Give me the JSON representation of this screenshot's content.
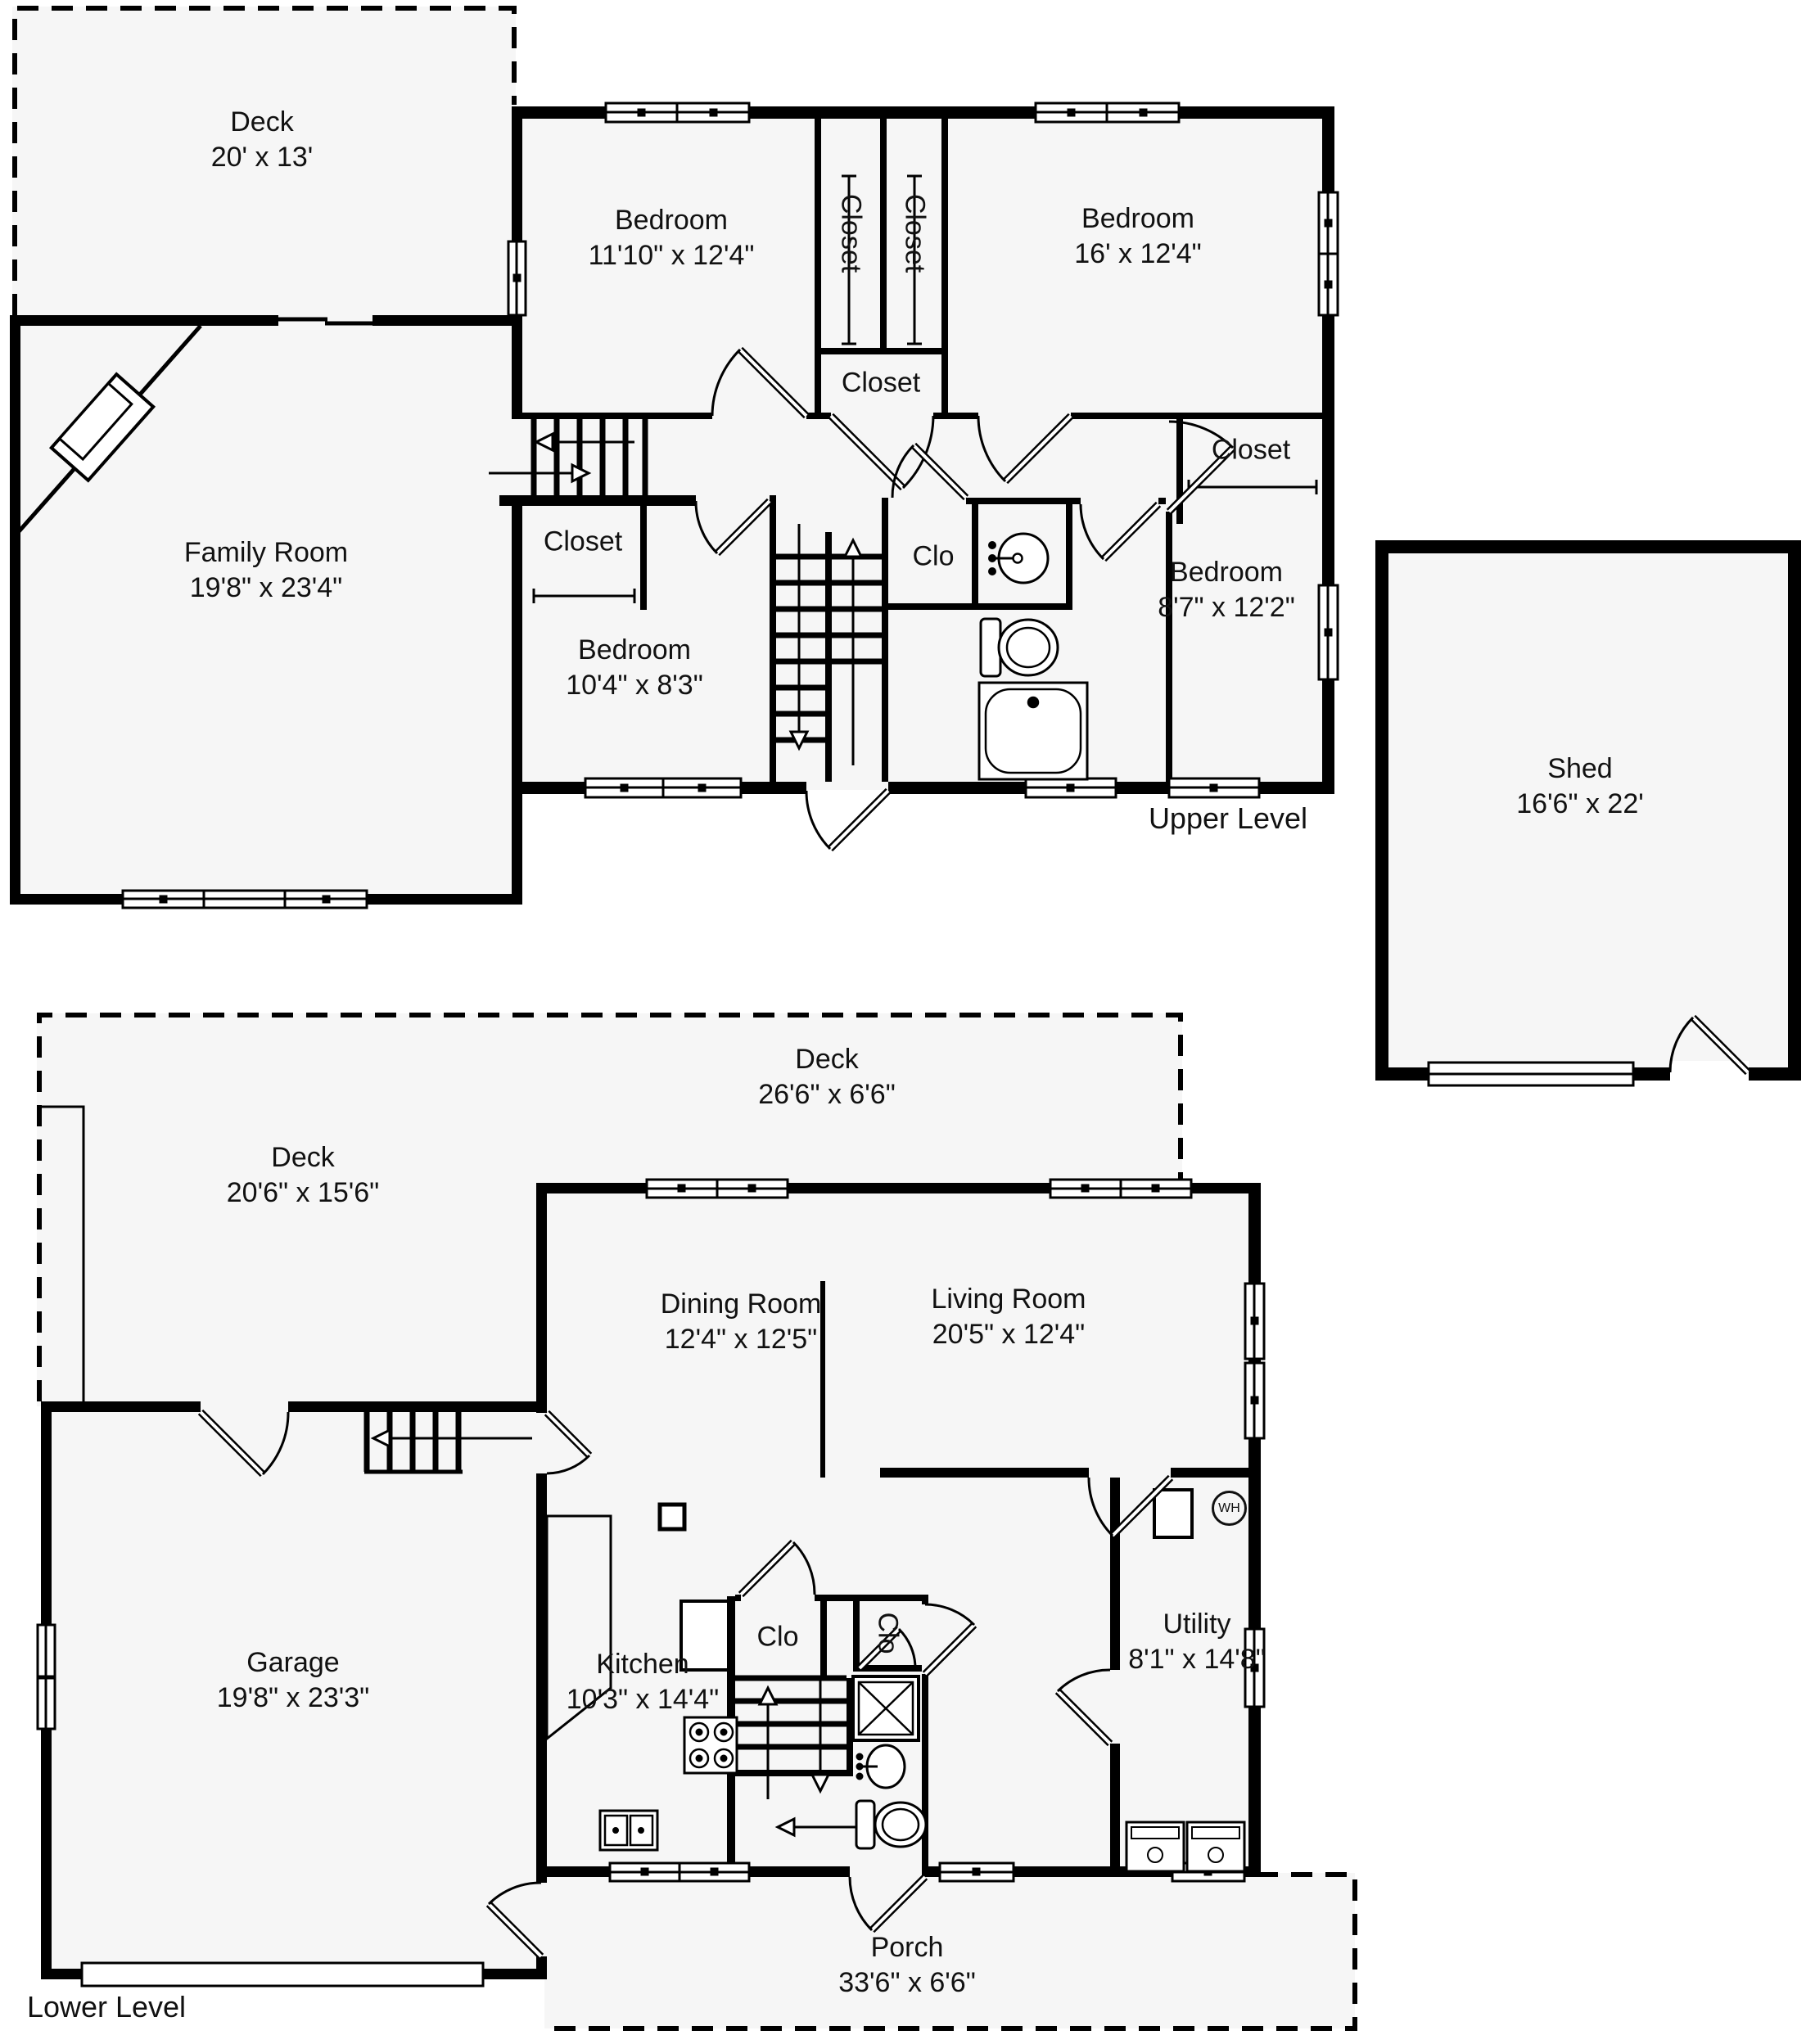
{
  "meta": {
    "type": "floorplan",
    "wall_color": "#000000",
    "floor_color": "#f6f6f6",
    "background": "#ffffff"
  },
  "levels": {
    "upper": "Upper Level",
    "lower": "Lower Level"
  },
  "rooms": {
    "upper_deck": {
      "name": "Deck",
      "dims": "20' x 13'"
    },
    "family_room": {
      "name": "Family Room",
      "dims": "19'8\" x 23'4\""
    },
    "bedroom_1": {
      "name": "Bedroom",
      "dims": "11'10\" x 12'4\""
    },
    "bedroom_2": {
      "name": "Bedroom",
      "dims": "16' x 12'4\""
    },
    "bedroom_3": {
      "name": "Bedroom",
      "dims": "8'7\" x 12'2\""
    },
    "bedroom_4": {
      "name": "Bedroom",
      "dims": "10'4\" x 8'3\""
    },
    "shed": {
      "name": "Shed",
      "dims": "16'6\" x 22'"
    },
    "lower_deck_top": {
      "name": "Deck",
      "dims": "26'6\" x 6'6\""
    },
    "lower_deck_left": {
      "name": "Deck",
      "dims": "20'6\" x 15'6\""
    },
    "dining_room": {
      "name": "Dining Room",
      "dims": "12'4\" x 12'5\""
    },
    "living_room": {
      "name": "Living Room",
      "dims": "20'5\" x 12'4\""
    },
    "garage": {
      "name": "Garage",
      "dims": "19'8\" x 23'3\""
    },
    "kitchen": {
      "name": "Kitchen",
      "dims": "10'3\" x 14'4\""
    },
    "utility": {
      "name": "Utility",
      "dims": "8'1\" x 14'8\""
    },
    "porch": {
      "name": "Porch",
      "dims": "33'6\" x 6'6\""
    }
  },
  "closets": {
    "tall_a": "Closet",
    "tall_b": "Closet",
    "hall": "Closet",
    "right": "Closet",
    "bedroom4": "Closet",
    "upper_clo": "Clo",
    "center_clo": "Clo",
    "right_clo": "Clo"
  },
  "appliances": {
    "water_heater": "WH"
  }
}
